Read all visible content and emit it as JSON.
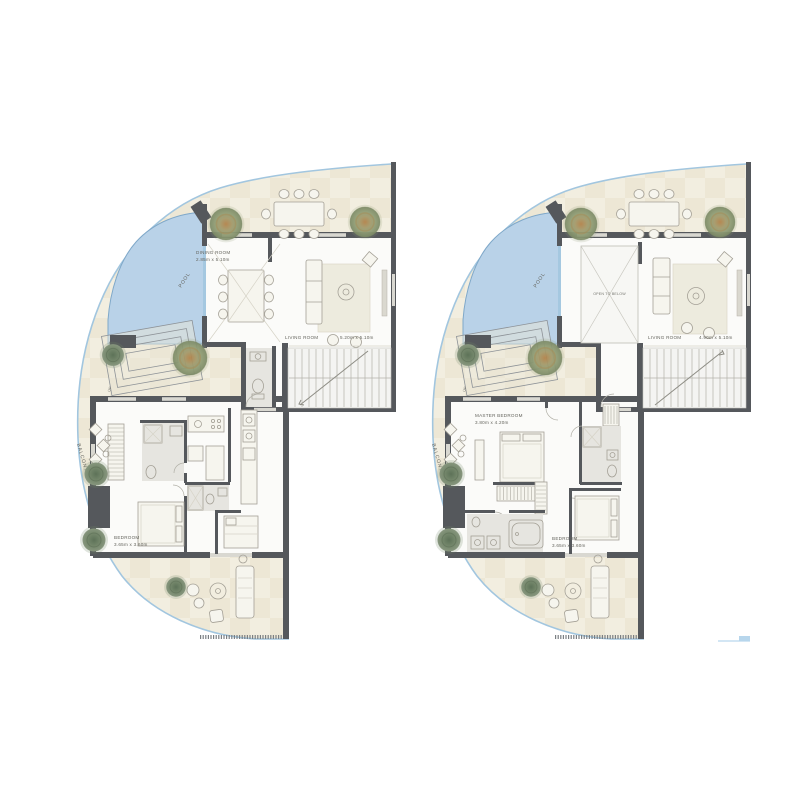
{
  "page": {
    "background": "#ffffff",
    "description": "Two residential duplex floor plans side by side: lower level (left) and upper level (right)"
  },
  "palette": {
    "wall": "#55585c",
    "pool_water": "#b9d2e8",
    "pool_edge": "#7fa8c9",
    "glass_rail": "#a2c6df",
    "terrace_tile": "#f2eee0",
    "terrace_tile_alt": "#e9e1cc",
    "interior_floor": "#fbfbf9",
    "bath_floor": "#e6e5e0",
    "furniture_line": "#a4a096",
    "tree_olive": "#8f9c74",
    "tree_amber": "#b28148",
    "plant_green": "#74876b",
    "label_text": "#64645d"
  },
  "plan_left": {
    "id": "lower-level",
    "labels": {
      "balcony": "BALCONY",
      "pool": "POOL",
      "up": "UP",
      "dining_name": "DINING ROOM",
      "dining_dims": "2.85m x 5.10m",
      "living_name": "LIVING ROOM",
      "living_dims": "5.20m x 5.10m",
      "bedroom_name": "BEDROOM",
      "bedroom_dims": "3.65m x 3.60m"
    }
  },
  "plan_right": {
    "id": "upper-level",
    "labels": {
      "balcony": "BALCONY",
      "pool": "POOL",
      "up": "UP",
      "open_below": "OPEN TO BELOW",
      "living_name": "LIVING ROOM",
      "living_dims": "4.90m x 5.10m",
      "master_name": "MASTER BEDROOM",
      "master_dims": "3.80m x 4.20m",
      "bedroom_name": "BEDROOM",
      "bedroom_dims": "3.65m x 3.60m"
    }
  }
}
